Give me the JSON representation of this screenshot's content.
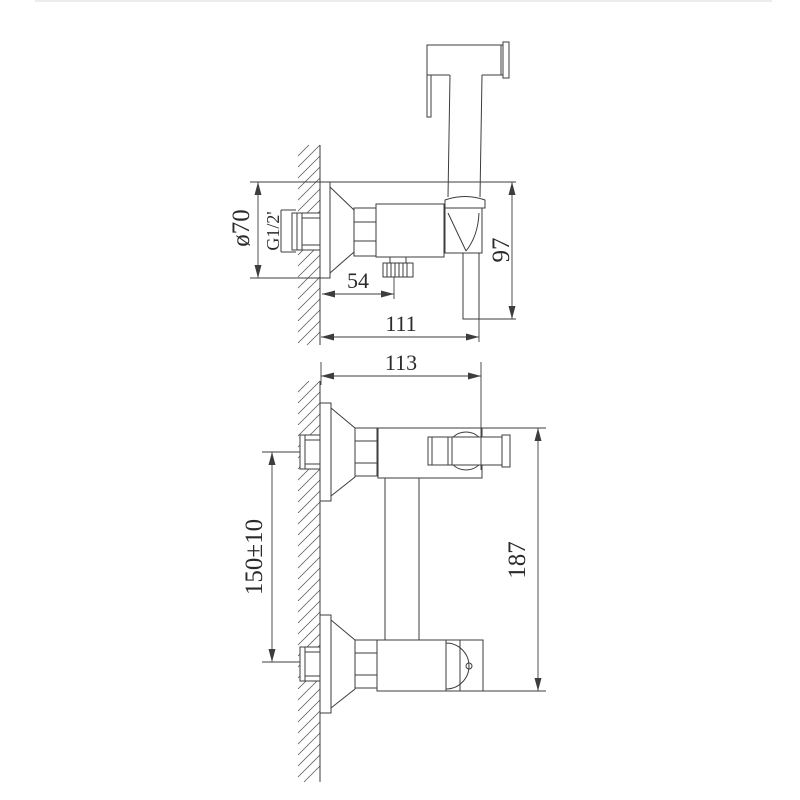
{
  "title": "Wall-mounted hygienic sprayer mixer technical drawing",
  "colors": {
    "line": "#3d3d3d",
    "text": "#2b2b2b",
    "background": "#ffffff"
  },
  "views": {
    "side_view": {
      "labels": {
        "flange_diameter": "ø70",
        "thread_size": "G1/2'",
        "knob_offset": "54",
        "depth_total": "111",
        "height_body": "97"
      }
    },
    "front_view": {
      "labels": {
        "width_total": "113",
        "inlet_spacing": "150±10",
        "height_total": "187"
      }
    }
  }
}
